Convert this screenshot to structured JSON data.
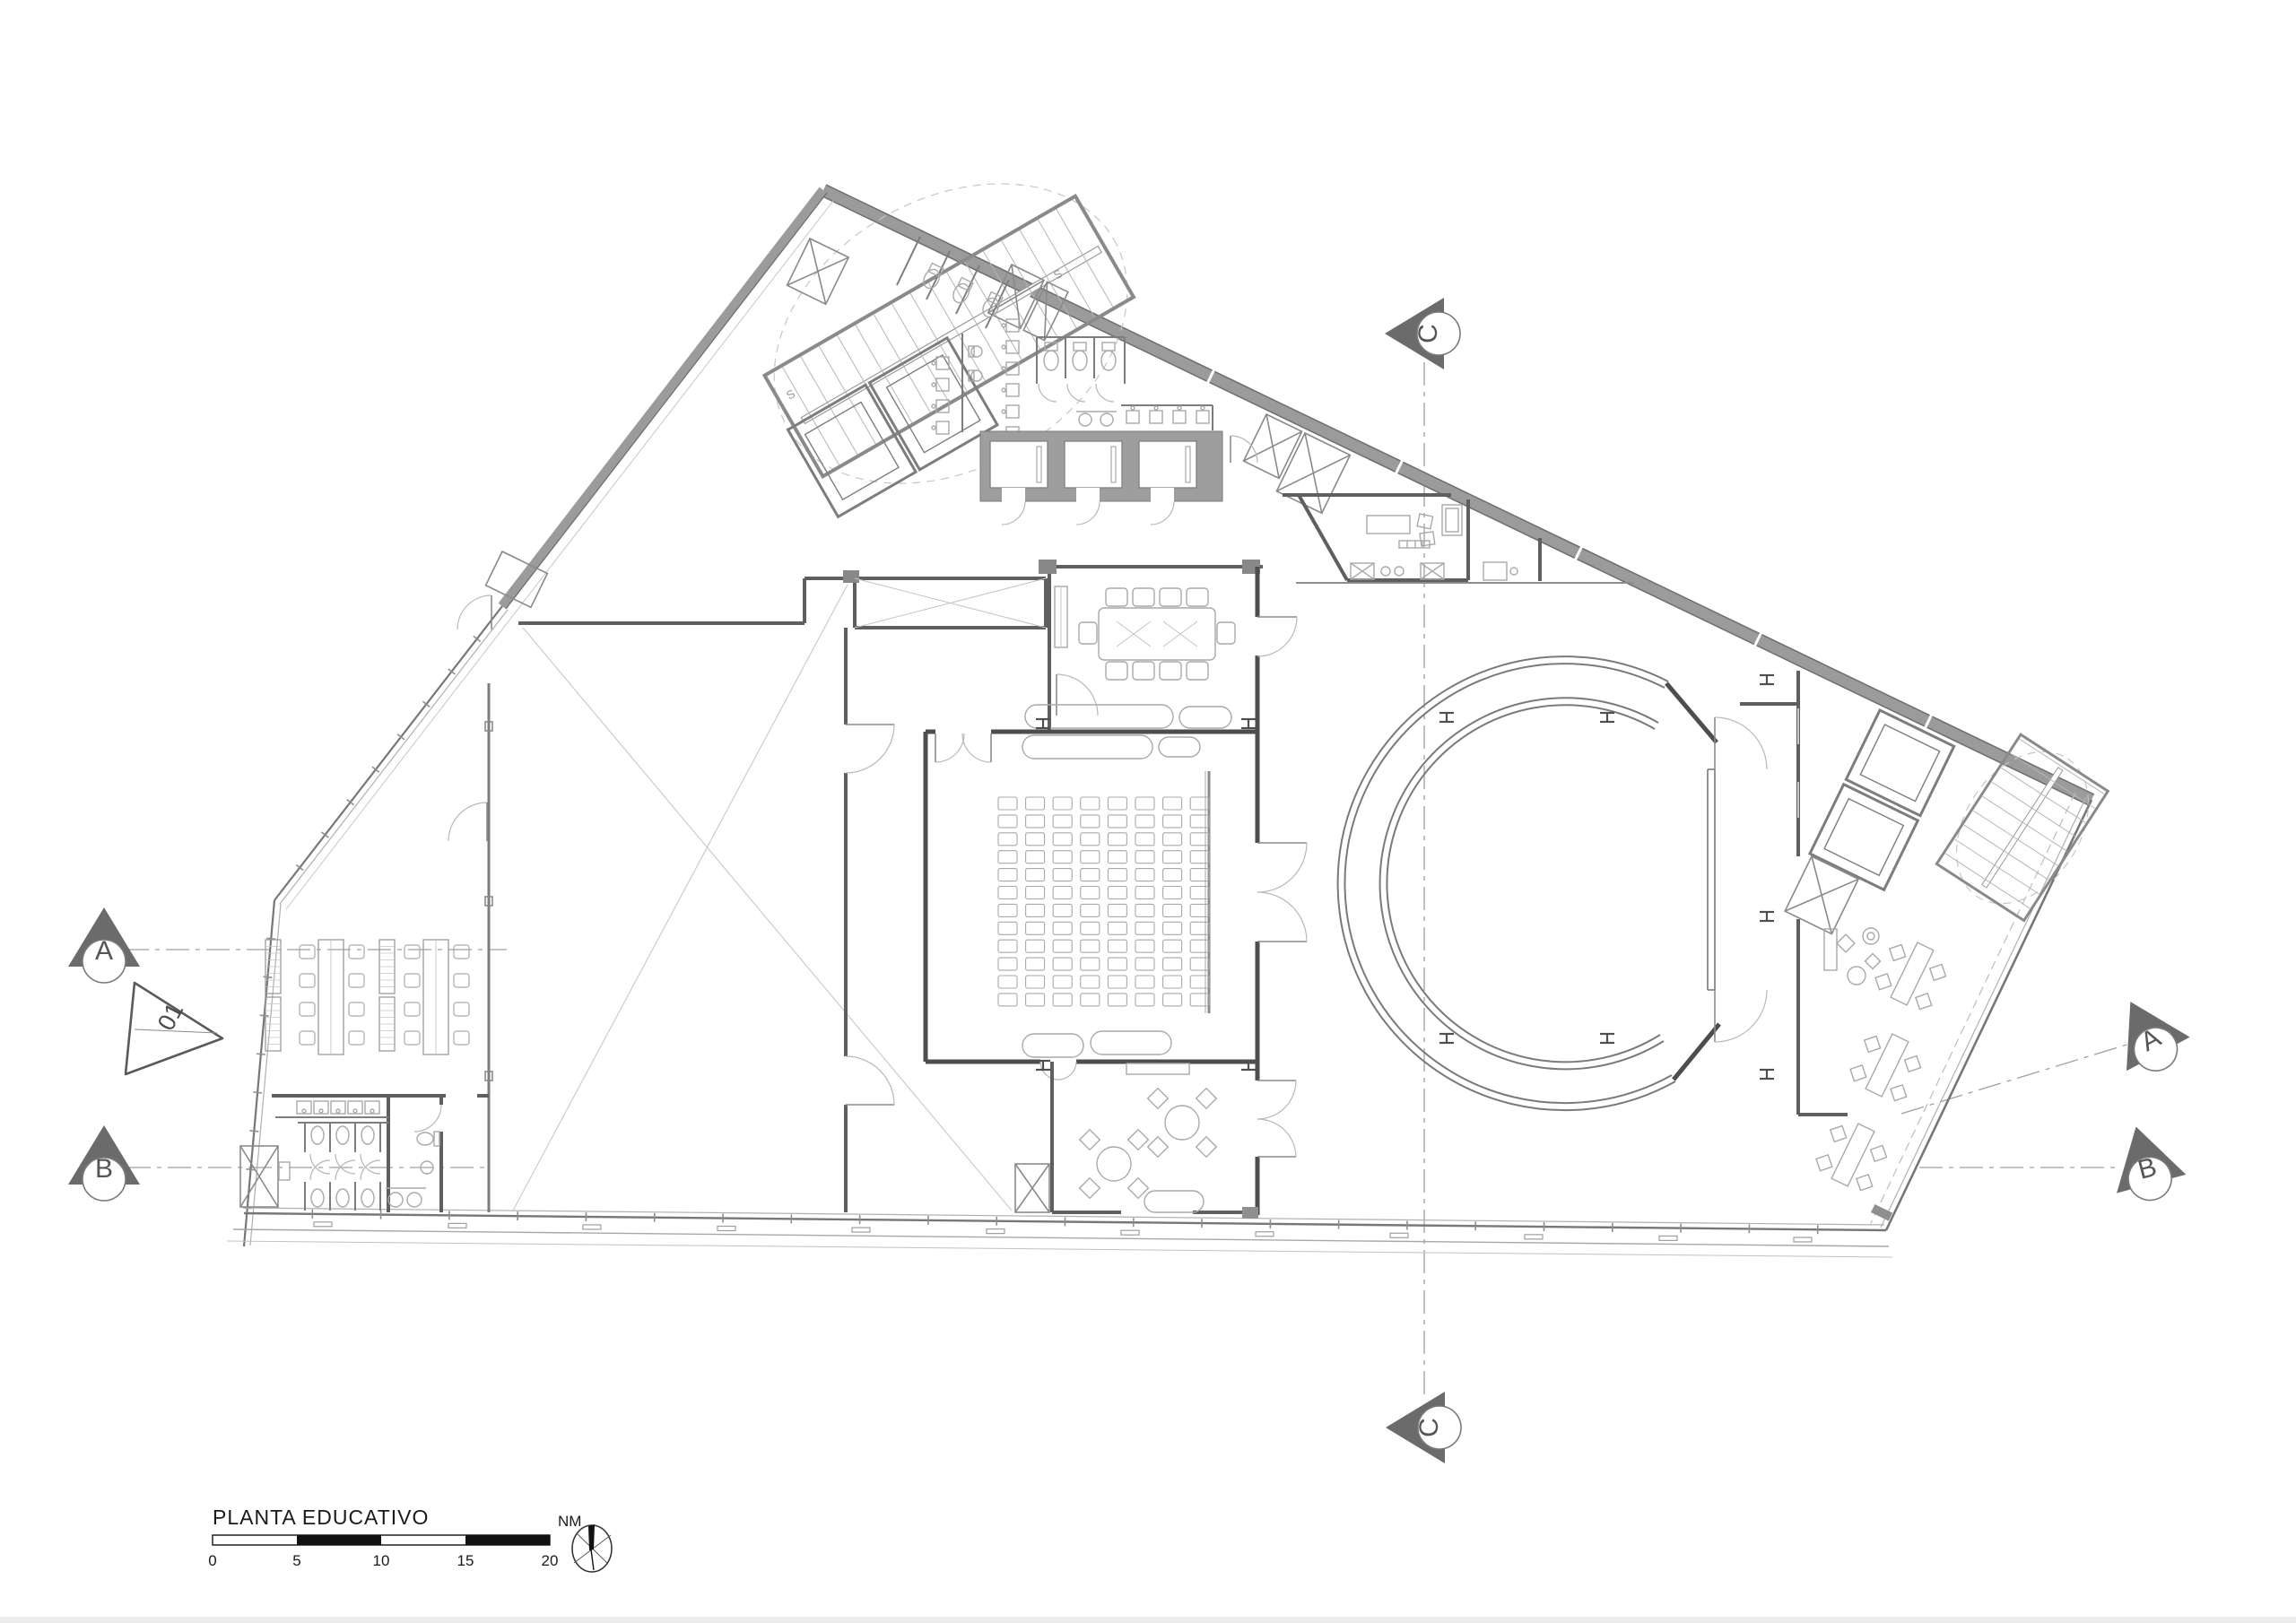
{
  "plan": {
    "title": "PLANTA EDUCATIVO"
  },
  "grid_markers": {
    "left_a": "A",
    "left_b": "B",
    "right_a": "A",
    "right_b": "B",
    "top_c": "C",
    "bottom_c": "C"
  },
  "section_marker": {
    "label": "01"
  },
  "stairs": {
    "label_1": "S",
    "label_2": "S"
  },
  "scale_bar": {
    "labels": [
      "0",
      "5",
      "10",
      "15",
      "20"
    ]
  },
  "north": {
    "label": "NM"
  },
  "colors": {
    "wall_dark": "#4d4d4d",
    "wall_medium": "#5f5f5f",
    "band_grey": "#9b9b9b",
    "poche_grey": "#9e9e9e",
    "light_line": "#b3b3b3",
    "text": "#1a1a1a",
    "scale_black": "#111111"
  }
}
